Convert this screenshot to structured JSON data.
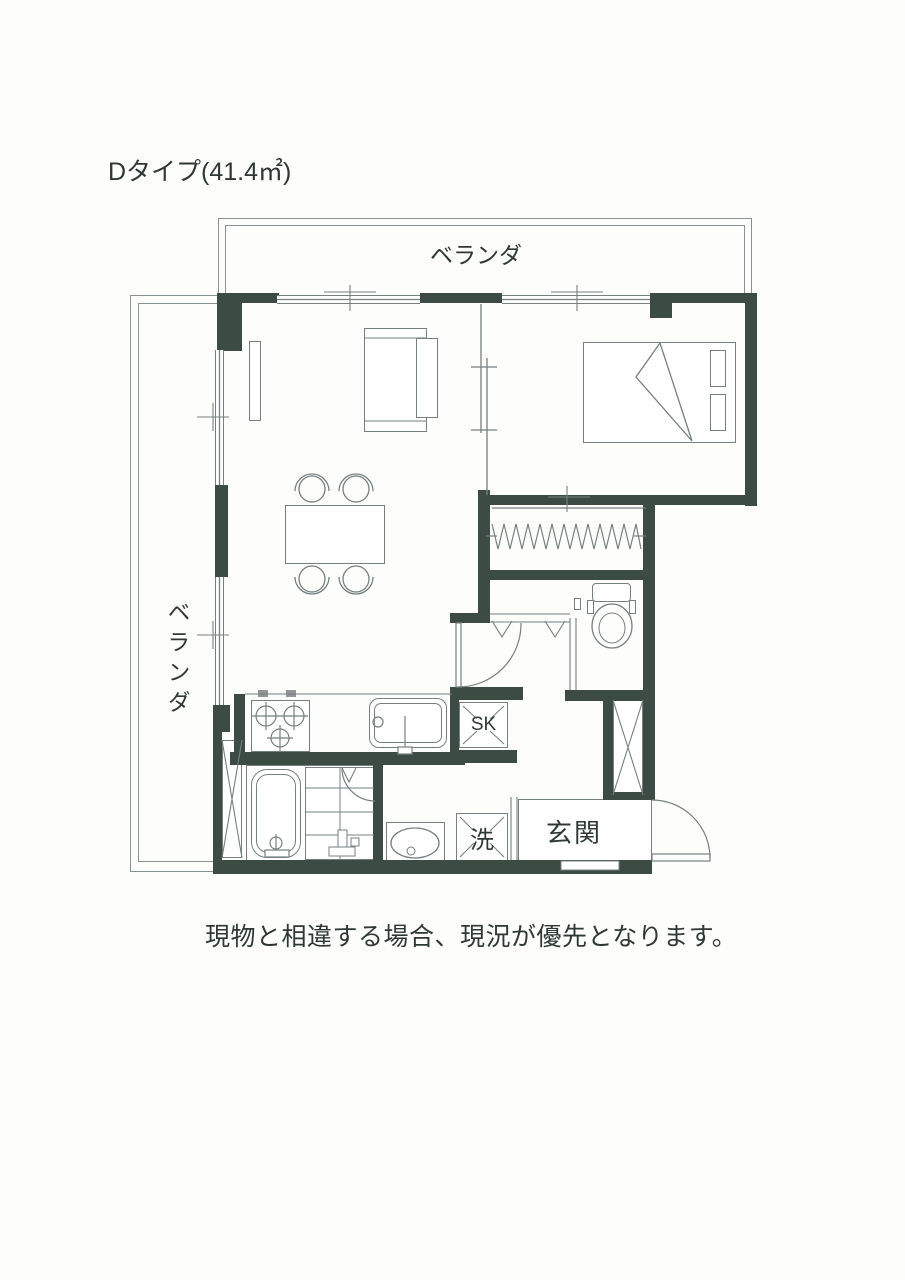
{
  "title": "Dタイプ(41.4㎡)",
  "labels": {
    "veranda_top": "ベランダ",
    "veranda_left": "ベランダ",
    "sink": "SK",
    "laundry": "洗",
    "entrance": "玄関"
  },
  "caption": "現物と相違する場合、現況が優先となります。",
  "colors": {
    "wall": "#3d4b45",
    "line": "#75807f",
    "text": "#2e3835"
  }
}
